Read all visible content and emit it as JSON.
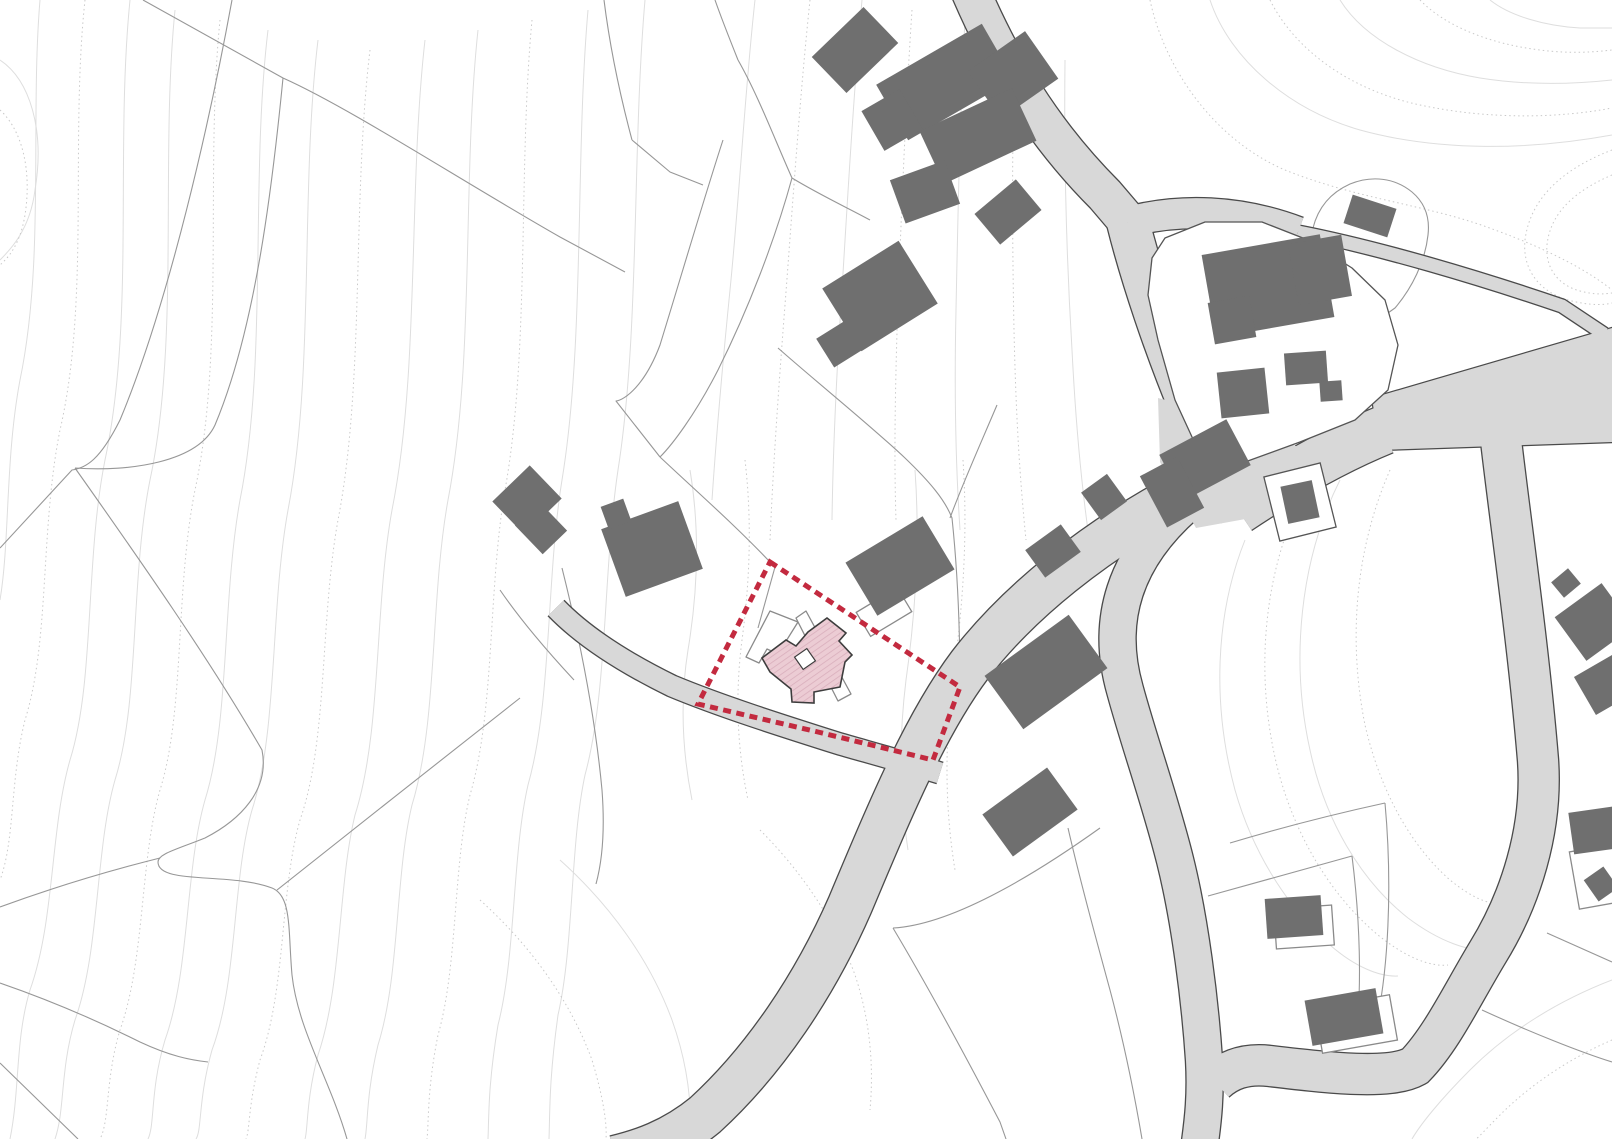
{
  "map": {
    "kind": "cadastral-site-plan",
    "width": 1612,
    "height": 1139,
    "colors": {
      "background": "#ffffff",
      "contour": "#dedede",
      "contour_dotted": "#c9c9c9",
      "parcel_line": "#979797",
      "road_fill": "#d8d8d8",
      "road_edge": "#4a4a4a",
      "building_fill": "#6f6f6f",
      "island_fill": "#ffffff",
      "island_stroke": "#555555",
      "outline_building_stroke": "#8a8a8a",
      "site_boundary": "#c32a3f",
      "new_building_fill": "#ecccd4",
      "new_building_hatch": "#d9aebc",
      "new_building_stroke": "#3d3d3d"
    },
    "contours": [
      {
        "d": "M40,0 C30,120 45,260 20,380 C5,460 10,540 0,600",
        "dotted": false
      },
      {
        "d": "M85,0 C70,140 90,300 60,430 C40,530 50,640 25,720 C10,780 15,840 0,880",
        "dotted": true
      },
      {
        "d": "M130,0 C115,150 135,320 105,460 C85,560 95,680 70,760 C50,830 55,920 30,990 C15,1040 20,1090 10,1139",
        "dotted": false
      },
      {
        "d": "M175,10 C160,160 180,340 150,480 C130,580 140,700 115,780 C95,850 100,950 75,1020 C60,1070 65,1110 55,1139",
        "dotted": false
      },
      {
        "d": "M220,20 C205,170 225,350 195,490 C175,590 185,710 160,790 C140,860 145,960 120,1030 C105,1080 110,1120 100,1139",
        "dotted": true
      },
      {
        "d": "M268,30 C250,180 268,360 240,500 C222,600 230,720 205,800 C185,870 190,970 165,1040 C150,1090 155,1125 148,1139",
        "dotted": false
      },
      {
        "d": "M318,40 C300,190 315,370 288,510 C270,610 278,730 252,810 C232,880 238,980 212,1050 C198,1100 202,1130 196,1139",
        "dotted": false
      },
      {
        "d": "M370,50 C352,200 365,380 338,520 C320,620 328,740 300,820 C280,890 286,990 260,1060 C248,1105 250,1130 246,1139",
        "dotted": true
      },
      {
        "d": "M425,40 C408,190 420,370 392,510 C374,610 382,730 355,815 C338,885 342,985 318,1055 C306,1100 308,1130 305,1139",
        "dotted": false
      },
      {
        "d": "M478,30 C462,180 475,360 448,500 C430,600 438,720 412,805 C395,875 400,975 378,1045 C366,1095 368,1125 365,1139",
        "dotted": false
      },
      {
        "d": "M532,20 C518,170 530,350 505,490 C488,590 495,710 470,795 C453,865 458,965 438,1035 C427,1090 429,1120 427,1139",
        "dotted": true
      },
      {
        "d": "M588,10 C575,160 585,340 562,480 C546,580 552,700 528,785 C512,855 516,955 498,1025 C488,1085 489,1115 488,1139",
        "dotted": false
      },
      {
        "d": "M645,0 C632,150 640,330 618,470 C603,570 608,690 585,775 C570,845 574,945 558,1015 C549,1080 550,1110 549,1139",
        "dotted": false
      },
      {
        "d": "M0,60 C30,80 45,130 35,190 C30,230 10,250 0,260",
        "dotted": false
      },
      {
        "d": "M0,110 C22,130 32,170 25,215 C20,245 8,258 0,265",
        "dotted": true
      },
      {
        "d": "M1210,0 C1230,60 1290,110 1360,130 C1440,152 1530,150 1612,135",
        "dotted": false
      },
      {
        "d": "M1270,0 C1295,50 1350,90 1420,105 C1490,120 1560,118 1612,108",
        "dotted": true
      },
      {
        "d": "M1340,0 C1365,40 1420,68 1480,78 C1530,86 1575,84 1612,80",
        "dotted": false
      },
      {
        "d": "M1420,0 C1445,26 1490,44 1540,50 C1570,54 1595,52 1612,50",
        "dotted": true
      },
      {
        "d": "M1490,0 C1510,16 1545,26 1580,28 L1612,28",
        "dotted": false
      },
      {
        "d": "M1150,0 C1165,70 1215,140 1285,170 C1360,200 1430,205 1495,230 C1550,250 1590,272 1612,290",
        "dotted": true
      },
      {
        "d": "M1612,150 C1560,170 1530,200 1525,240 C1522,270 1540,292 1568,300 C1590,306 1605,305 1612,303",
        "dotted": true
      },
      {
        "d": "M1612,175 C1572,192 1550,215 1547,245 C1545,268 1558,285 1580,291 C1595,295 1605,294 1612,293",
        "dotted": true
      },
      {
        "d": "M1340,480 C1300,560 1290,660 1310,750 C1325,820 1360,880 1408,918 C1440,942 1470,952 1490,950",
        "dotted": false
      },
      {
        "d": "M1390,470 C1355,550 1348,640 1365,725 C1380,790 1410,845 1450,880 C1472,898 1490,905 1500,903",
        "dotted": true
      },
      {
        "d": "M1300,500 C1262,580 1255,680 1278,770 C1295,835 1330,895 1378,935 C1405,957 1430,967 1448,965",
        "dotted": true
      },
      {
        "d": "M1245,540 C1215,615 1212,705 1235,790 C1252,850 1285,905 1330,945 C1355,967 1380,977 1398,976",
        "dotted": false
      },
      {
        "d": "M1612,980 C1560,1000 1510,1030 1470,1070 C1440,1100 1420,1125 1412,1139",
        "dotted": false
      },
      {
        "d": "M1612,1040 C1570,1058 1530,1085 1500,1115 C1485,1130 1478,1138 1476,1139",
        "dotted": true
      },
      {
        "d": "M560,860 C610,905 650,960 672,1020 C688,1065 692,1105 690,1139",
        "dotted": false
      },
      {
        "d": "M480,900 C530,945 570,1000 592,1060 C604,1100 607,1125 606,1139",
        "dotted": true
      },
      {
        "d": "M760,830 C800,870 835,920 855,975 C870,1020 874,1065 870,1110",
        "dotted": true
      },
      {
        "d": "M690,470 C700,530 698,590 688,650 C680,700 682,750 692,800",
        "dotted": false
      },
      {
        "d": "M745,460 C752,520 750,580 742,640 C735,695 737,748 748,800",
        "dotted": true
      },
      {
        "d": "M915,470 C920,540 916,610 906,680 C898,745 900,800 908,850",
        "dotted": false
      },
      {
        "d": "M963,460 C968,535 963,610 952,685 C944,755 946,815 955,870",
        "dotted": true
      },
      {
        "d": "M755,0 C745,90 740,190 730,290 C722,370 716,440 712,500",
        "dotted": false
      },
      {
        "d": "M810,0 C800,95 793,200 785,305 C778,395 773,470 770,540",
        "dotted": true
      },
      {
        "d": "M862,0 C854,90 848,190 842,290 C836,380 833,450 832,520",
        "dotted": false
      },
      {
        "d": "M912,10 C906,100 902,200 898,300 C895,390 894,460 896,520",
        "dotted": true
      },
      {
        "d": "M965,20 C960,110 958,210 956,310 C954,400 956,470 960,530",
        "dotted": false
      },
      {
        "d": "M1015,40 C1012,130 1012,230 1014,330 C1016,420 1020,480 1026,540",
        "dotted": true
      },
      {
        "d": "M1065,60 C1064,150 1066,250 1072,350 C1076,430 1082,490 1090,545",
        "dotted": false
      }
    ],
    "parcel_lines": [
      "M232,0 C210,120 170,300 120,420 C100,460 86,468 72,470 L0,548",
      "M143,0 L283,78",
      "M283,78 C350,108 460,180 560,237 L625,272",
      "M283,78 C272,190 255,330 215,425 C198,462 130,472 75,468",
      "M75,468 C140,560 210,660 262,750 C270,790 240,820 205,838 C175,850 158,854 158,862 C158,885 230,872 272,888 C292,896 288,930 292,975 C298,1030 330,1080 347,1139",
      "M0,907 C60,885 120,868 160,858",
      "M0,983 C55,1002 100,1022 140,1042 C170,1056 190,1060 208,1062",
      "M520,698 C460,745 340,840 277,890",
      "M0,1063 L78,1139",
      "M723,140 C705,195 680,280 660,345 C645,385 625,400 616,401 L660,457",
      "M792,178 C775,240 748,310 718,370 C695,415 672,445 660,457",
      "M792,178 C820,195 848,208 870,220",
      "M632,140 L670,172 L703,185",
      "M738,60 C758,95 775,140 792,178",
      "M715,0 C722,20 730,40 738,60",
      "M604,0 C610,48 620,95 632,140",
      "M660,457 C695,490 735,525 770,562",
      "M778,348 C820,385 870,425 905,458 C930,482 945,500 952,518 C958,575 960,630 960,687",
      "M775,567 L758,628",
      "M997,405 C980,445 962,485 950,518",
      "M1100,828 C1030,878 950,925 893,928 M893,928 C930,990 965,1055 1000,1122 L1006,1139",
      "M1068,828 C1080,880 1095,935 1110,990 C1122,1035 1132,1080 1142,1139",
      "M1230,843 C1280,828 1330,815 1385,803",
      "M1208,896 L1352,856",
      "M1385,803 C1392,880 1390,975 1372,1042",
      "M1352,856 C1360,920 1362,985 1356,1040",
      "M1547,933 L1612,962",
      "M1482,1010 C1530,1032 1580,1052 1612,1062",
      "M1313,228 C1318,208 1330,193 1350,184 C1372,175 1395,178 1412,192 C1425,203 1430,218 1428,235 C1425,262 1412,288 1395,308 L1378,320",
      "M562,568 C580,640 595,715 602,790 C605,830 602,862 596,884",
      "M500,590 C522,622 548,652 574,680"
    ],
    "roads": [
      {
        "d": "M970,-10 C1000,60 1040,130 1105,195 L1128,222",
        "w": 38
      },
      {
        "d": "M1128,222 C1180,208 1240,210 1298,232",
        "w": 30
      },
      {
        "d": "M1298,232 C1380,248 1480,278 1562,306 L1604,334",
        "w": 13
      },
      {
        "d": "M1128,222 C1140,270 1165,350 1200,430 C1215,465 1228,492 1240,512",
        "w": 42
      },
      {
        "d": "M1238,510 C1280,482 1330,452 1384,430",
        "w": 48
      },
      {
        "d": "M1500,432 C1510,520 1528,640 1538,760 C1543,830 1520,900 1488,952 C1462,995 1442,1038 1415,1066 C1390,1080 1330,1073 1270,1066 C1245,1063 1228,1070 1215,1082",
        "w": 40
      },
      {
        "d": "M1175,498 C1095,542 1020,600 970,665 C925,725 890,810 850,905 C815,985 765,1060 705,1115 C672,1142 640,1152 615,1158",
        "w": 44
      },
      {
        "d": "M1185,505 C1125,558 1105,620 1125,690 C1140,745 1160,800 1175,860 C1190,920 1200,1000 1204,1060 C1206,1095 1203,1120 1200,1142",
        "w": 36
      },
      {
        "d": "M556,608 C585,638 625,663 672,686 C720,706 780,725 840,744 C875,754 908,763 940,773",
        "w": 21
      }
    ],
    "road_polygons": [
      {
        "points": "1372,398 1612,328 1612,442 1380,450",
        "edged": true
      },
      {
        "points": "1158,398 1238,418 1308,452 1262,516 1196,528 1160,462",
        "edged": false
      }
    ],
    "islands": [
      {
        "type": "poly",
        "points": "1152,258 1165,238 1205,222 1262,222 1308,240 1352,268 1385,300 1398,345 1388,390 1355,420 1300,442 1245,462 1218,470 1198,450 1175,400 1158,340 1148,295"
      },
      {
        "type": "rect",
        "cx": 1300,
        "cy": 502,
        "w": 58,
        "h": 66,
        "rot": -14
      }
    ],
    "outline_shapes": [
      {
        "type": "poly",
        "points": "746,657 759,663 767,649 778,654 798,622 770,611"
      },
      {
        "type": "poly",
        "points": "796,618 806,611 851,694 838,701"
      },
      {
        "type": "rect",
        "cx": 884,
        "cy": 612,
        "w": 48,
        "h": 28,
        "rot": -31
      },
      {
        "type": "rect",
        "cx": 1304,
        "cy": 927,
        "w": 58,
        "h": 40,
        "rot": -4
      },
      {
        "type": "rect",
        "cx": 1356,
        "cy": 1024,
        "w": 76,
        "h": 46,
        "rot": -10
      },
      {
        "type": "rect",
        "cx": 1600,
        "cy": 876,
        "w": 52,
        "h": 58,
        "rot": -10
      }
    ],
    "buildings": [
      {
        "cx": 855,
        "cy": 50,
        "w": 72,
        "h": 50,
        "rot": -44
      },
      {
        "cx": 945,
        "cy": 82,
        "w": 122,
        "h": 64,
        "rot": -30
      },
      {
        "cx": 1013,
        "cy": 75,
        "w": 70,
        "h": 58,
        "rot": -35
      },
      {
        "cx": 978,
        "cy": 136,
        "w": 102,
        "h": 58,
        "rot": -25
      },
      {
        "cx": 892,
        "cy": 120,
        "w": 44,
        "h": 46,
        "rot": -30
      },
      {
        "cx": 925,
        "cy": 192,
        "w": 58,
        "h": 46,
        "rot": -20
      },
      {
        "cx": 1008,
        "cy": 212,
        "w": 54,
        "h": 40,
        "rot": -40
      },
      {
        "cx": 880,
        "cy": 296,
        "w": 90,
        "h": 74,
        "rot": -32
      },
      {
        "cx": 843,
        "cy": 342,
        "w": 42,
        "h": 34,
        "rot": -32
      },
      {
        "cx": 1370,
        "cy": 216,
        "w": 46,
        "h": 30,
        "rot": 18
      },
      {
        "cx": 1268,
        "cy": 286,
        "w": 120,
        "h": 84,
        "rot": -10
      },
      {
        "cx": 1320,
        "cy": 270,
        "w": 54,
        "h": 62,
        "rot": -10
      },
      {
        "cx": 1232,
        "cy": 320,
        "w": 42,
        "h": 42,
        "rot": -10
      },
      {
        "cx": 1243,
        "cy": 393,
        "w": 48,
        "h": 46,
        "rot": -6
      },
      {
        "cx": 1306,
        "cy": 368,
        "w": 42,
        "h": 32,
        "rot": -4
      },
      {
        "cx": 1331,
        "cy": 391,
        "w": 22,
        "h": 20,
        "rot": -4
      },
      {
        "cx": 1205,
        "cy": 460,
        "w": 76,
        "h": 52,
        "rot": -28
      },
      {
        "cx": 1172,
        "cy": 492,
        "w": 42,
        "h": 58,
        "rot": -28
      },
      {
        "cx": 1104,
        "cy": 497,
        "w": 32,
        "h": 34,
        "rot": -36
      },
      {
        "cx": 1300,
        "cy": 502,
        "w": 32,
        "h": 38,
        "rot": -12
      },
      {
        "cx": 1053,
        "cy": 551,
        "w": 44,
        "h": 34,
        "rot": -36
      },
      {
        "cx": 1046,
        "cy": 672,
        "w": 104,
        "h": 66,
        "rot": -36
      },
      {
        "cx": 1030,
        "cy": 812,
        "w": 80,
        "h": 52,
        "rot": -36
      },
      {
        "cx": 527,
        "cy": 500,
        "w": 52,
        "h": 46,
        "rot": -44
      },
      {
        "cx": 541,
        "cy": 528,
        "w": 34,
        "h": 40,
        "rot": -44
      },
      {
        "cx": 652,
        "cy": 549,
        "w": 82,
        "h": 72,
        "rot": -20
      },
      {
        "cx": 616,
        "cy": 514,
        "w": 24,
        "h": 24,
        "rot": -20
      },
      {
        "cx": 900,
        "cy": 566,
        "w": 90,
        "h": 62,
        "rot": -31
      },
      {
        "cx": 1566,
        "cy": 583,
        "w": 22,
        "h": 20,
        "rot": -40
      },
      {
        "cx": 1594,
        "cy": 622,
        "w": 58,
        "h": 54,
        "rot": -36
      },
      {
        "cx": 1604,
        "cy": 685,
        "w": 44,
        "h": 44,
        "rot": -30
      },
      {
        "cx": 1597,
        "cy": 830,
        "w": 52,
        "h": 42,
        "rot": -8
      },
      {
        "cx": 1601,
        "cy": 884,
        "w": 24,
        "h": 26,
        "rot": -35
      },
      {
        "cx": 1294,
        "cy": 917,
        "w": 56,
        "h": 40,
        "rot": -4
      },
      {
        "cx": 1344,
        "cy": 1017,
        "w": 72,
        "h": 46,
        "rot": -10
      }
    ],
    "site": {
      "boundary_points": "770,562 960,687 933,760 818,732 698,704",
      "boundary_dash": "8 5.5",
      "boundary_width": 5,
      "new_building_points": "827,618 846,633 839,641 852,655 845,662 840,687 814,692 814,703 792,702 791,689 770,672 762,658 786,640 796,646 808,632",
      "notch": {
        "cx": 805,
        "cy": 659,
        "w": 15,
        "h": 15,
        "rot": -35
      }
    }
  }
}
